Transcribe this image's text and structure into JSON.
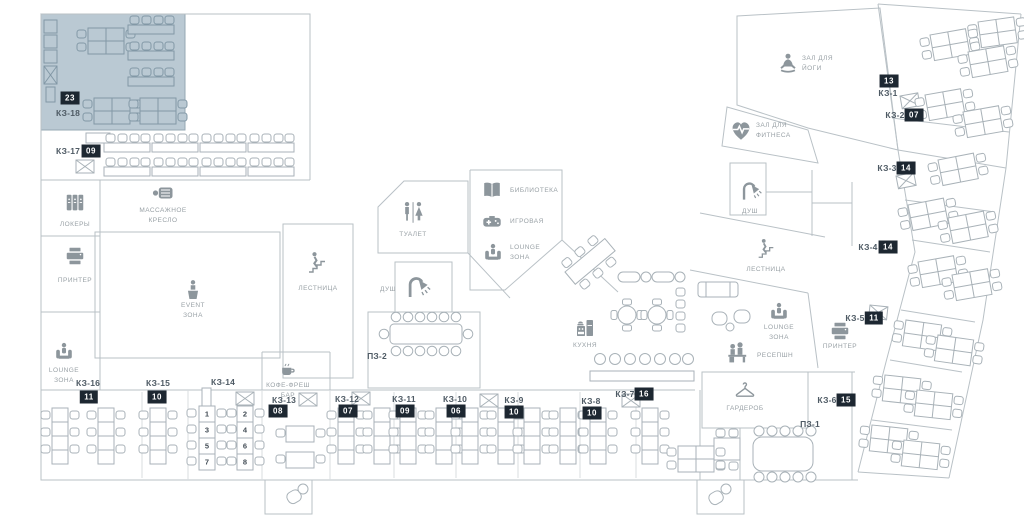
{
  "title": "Office floor plan",
  "colors": {
    "highlight_room": "#bac9d3",
    "badge_bg": "#1d2731",
    "badge_text": "#ffffff",
    "walls": "#b9c1c6",
    "icon_gray": "#8d969c"
  },
  "zones": {
    "lockers": {
      "label": "ЛОКЕРЫ"
    },
    "printer_left": {
      "label": "ПРИНТЕР"
    },
    "massage_chair": {
      "label": "МАССАЖНОЕ КРЕСЛО"
    },
    "event_zone": {
      "label": "EVENT ЗОНА"
    },
    "lounge_left": {
      "label": "LOUNGE ЗОНА"
    },
    "stairs_center": {
      "label": "ЛЕСТНИЦА"
    },
    "toilet": {
      "label": "ТУАЛЕТ"
    },
    "shower_center": {
      "label": "ДУШ"
    },
    "coffee_bar": {
      "label": "КОФЕ-ФРЕШ БАР"
    },
    "library": {
      "label": "БИБЛИОТЕКА"
    },
    "game_room": {
      "label": "ИГРОВАЯ"
    },
    "lounge_center": {
      "label": "LOUNGE ЗОНА"
    },
    "kitchen": {
      "label": "КУХНЯ"
    },
    "stairs_right": {
      "label": "ЛЕСТНИЦА"
    },
    "lounge_right": {
      "label": "LOUNGE ЗОНА"
    },
    "reception": {
      "label": "РЕСЕПШН"
    },
    "yoga_hall": {
      "label": "ЗАЛ ДЛЯ ЙОГИ"
    },
    "fitness_hall": {
      "label": "ЗАЛ ДЛЯ ФИТНЕСА"
    },
    "shower_right": {
      "label": "ДУШ"
    },
    "wardrobe": {
      "label": "ГАРДЕРОБ"
    },
    "printer_right": {
      "label": "ПРИНТЕР"
    }
  },
  "rooms": {
    "kz1": {
      "label": "КЗ-1",
      "badge": "13"
    },
    "kz2": {
      "label": "КЗ-2",
      "badge": "07"
    },
    "kz3": {
      "label": "КЗ-3",
      "badge": "14"
    },
    "kz4": {
      "label": "КЗ-4",
      "badge": "14"
    },
    "kz5": {
      "label": "КЗ-5",
      "badge": "11"
    },
    "kz6": {
      "label": "КЗ-6",
      "badge": "15"
    },
    "kz7": {
      "label": "КЗ-7",
      "badge": "16"
    },
    "kz8": {
      "label": "КЗ-8",
      "badge": "10"
    },
    "kz9": {
      "label": "КЗ-9",
      "badge": "10"
    },
    "kz10": {
      "label": "КЗ-10",
      "badge": "06"
    },
    "kz11": {
      "label": "КЗ-11",
      "badge": "09"
    },
    "kz12": {
      "label": "КЗ-12",
      "badge": "07"
    },
    "kz13": {
      "label": "КЗ-13",
      "badge": "08"
    },
    "kz14": {
      "label": "КЗ-14",
      "desk_numbers": [
        "1",
        "2",
        "3",
        "4",
        "5",
        "6",
        "7",
        "8"
      ]
    },
    "kz15": {
      "label": "КЗ-15",
      "badge": "10"
    },
    "kz16": {
      "label": "КЗ-16",
      "badge": "11"
    },
    "kz17": {
      "label": "КЗ-17",
      "badge": "09"
    },
    "kz18": {
      "label": "КЗ-18",
      "badge": "23"
    },
    "pz1": {
      "label": "ПЗ-1"
    },
    "pz2": {
      "label": "ПЗ-2"
    }
  }
}
